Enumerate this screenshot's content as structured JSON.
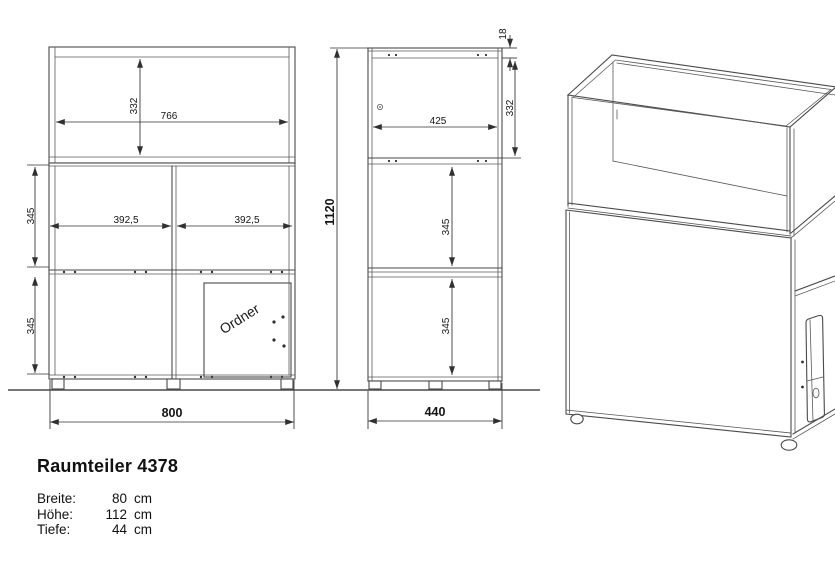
{
  "product": {
    "title": "Raumteiler 4378",
    "specs": [
      {
        "label": "Breite:",
        "value": "80",
        "unit": "cm"
      },
      {
        "label": "Höhe:",
        "value": "112",
        "unit": "cm"
      },
      {
        "label": "Tiefe:",
        "value": "44",
        "unit": "cm"
      }
    ]
  },
  "front_view": {
    "dim_top_inner_height": "332",
    "dim_top_inner_width": "766",
    "dim_middle_row_height": "345",
    "dim_left_compartment_width": "392,5",
    "dim_right_compartment_width": "392,5",
    "dim_bottom_row_height": "345",
    "dim_total_width": "800",
    "door_label": "Ordner"
  },
  "side_view": {
    "dim_top_panel_thickness": "18",
    "dim_top_inner_height": "332",
    "dim_inner_depth": "425",
    "dim_total_height": "1120",
    "dim_upper_compartment_height": "345",
    "dim_lower_compartment_height": "345",
    "dim_total_depth": "440"
  }
}
